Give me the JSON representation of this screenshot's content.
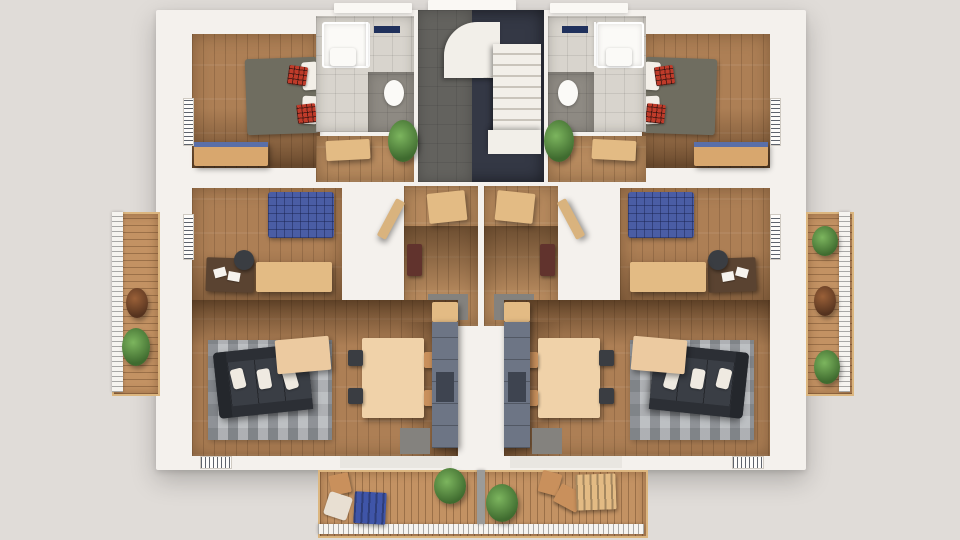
{
  "scene": {
    "type": "3d-architectural-floorplan-render",
    "description": "Top-down 3D cutaway render of one residential floor containing two mirrored apartment units around a central stairwell, with side balconies and a shared bottom balcony. No text labels are rendered in the image.",
    "units": [
      "left apartment",
      "right apartment"
    ],
    "rooms": [
      {
        "id": "building",
        "label": "Apartment floor – 3D cutaway"
      },
      {
        "id": "stairwell",
        "label": "Central stairwell with winding staircase"
      },
      {
        "id": "bathroom-left",
        "label": "Bathroom (left unit)"
      },
      {
        "id": "bathroom-right",
        "label": "Bathroom (right unit)"
      },
      {
        "id": "bedroom-top-left",
        "label": "Bedroom with double bed (left unit)"
      },
      {
        "id": "bedroom-top-right",
        "label": "Bedroom with double bed (right unit)"
      },
      {
        "id": "hall-left",
        "label": "Hall passage (left unit)"
      },
      {
        "id": "hall-right",
        "label": "Hall passage (right unit)"
      },
      {
        "id": "bedroom-mid-left",
        "label": "Bedroom / office with blue bed (left unit)"
      },
      {
        "id": "bedroom-mid-right",
        "label": "Bedroom / office with blue bed (right unit)"
      },
      {
        "id": "entry-left",
        "label": "Entry hall (left unit)"
      },
      {
        "id": "entry-right",
        "label": "Entry hall (right unit)"
      },
      {
        "id": "living-left",
        "label": "Living room with kitchen (left unit)"
      },
      {
        "id": "living-right",
        "label": "Living room with kitchen (right unit)"
      },
      {
        "id": "balcony-left",
        "label": "Side balcony (left)"
      },
      {
        "id": "balcony-right",
        "label": "Side balcony (right)"
      },
      {
        "id": "balcony-bottom",
        "label": "Shared bottom balcony"
      }
    ],
    "furniture": {
      "bedroom-top": [
        "double bed with olive-gray cover",
        "white pillows",
        "red plaid cushions",
        "wood wardrobe with blue top"
      ],
      "bedroom-mid": [
        "blue tufted double bed",
        "dark desk with papers",
        "office chair",
        "light wood credenza",
        "light wood dresser"
      ],
      "bathroom": [
        "shower",
        "sink",
        "toilet",
        "navy towel rail"
      ],
      "living": [
        "dark L-shaped sofa with white pillows",
        "gray patterned rug",
        "light wood coffee table",
        "dining table with four chairs",
        "gray-blue kitchen unit",
        "door mat"
      ],
      "entry": [
        "coat rack bench",
        "small red-brown cabinet",
        "gray doormat",
        "open door"
      ],
      "stairwell": [
        "white winding staircase",
        "dark tiled floor"
      ],
      "balconies": [
        "wood decking",
        "white railings",
        "green plants",
        "rust shrub",
        "blue lounger table",
        "wood chairs",
        "slatted table"
      ]
    }
  },
  "palette": {
    "bg": "#e0dcd8",
    "wall": "#f4f1ed",
    "wood": "#ad7f55",
    "woodHall": "#b78a5e",
    "deck": "#c39263",
    "tileLight": "#d8d4cd",
    "tileDark": "#8e8a83",
    "stairTile": "#343845",
    "stairTileLight": "#63625e",
    "stepWhite": "#f2efe9",
    "bedOlive": "#6f6d60",
    "pillow": "#f3efe8",
    "plaidRed": "#bf3b2a",
    "bedBlue": "#4a5da5",
    "sofa": "#33363c",
    "rug": "#abaeb2",
    "tableTan": "#f0d2a9",
    "coffeeTan": "#eccaa0",
    "chairDark": "#3a3d42",
    "chairTan": "#c9905c",
    "wardrobeTan": "#d8a76e",
    "wardrobeBlue": "#5a6fa8",
    "deskBrown": "#5a4331",
    "credenzaTan": "#e3bb84",
    "kitchenGray": "#6d7585",
    "kitchenDark": "#3e4450",
    "matGray": "#84827e",
    "towelNavy": "#20315c",
    "loungerBlue": "#3f55a8",
    "railWhite": "#f6f4f0",
    "doorTan": "#d9b37e",
    "paper": "#f6f3ee",
    "threshold": "#e9e6e1",
    "loungePale": "#e8dfd2"
  }
}
